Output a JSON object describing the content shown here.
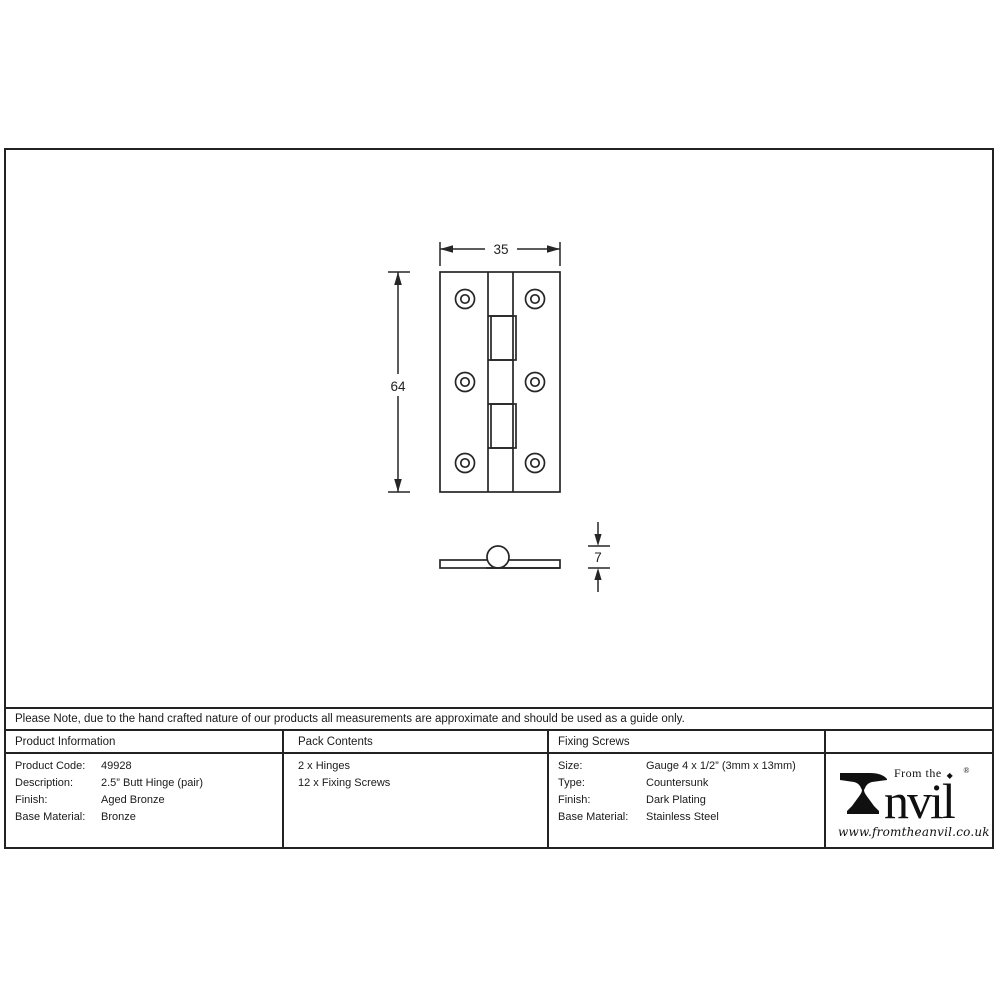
{
  "drawing": {
    "width_dim": "35",
    "height_dim": "64",
    "thickness_dim": "7"
  },
  "note": "Please Note, due to the hand crafted nature of our products all measurements are approximate and should be used as a guide only.",
  "table": {
    "product_info": {
      "header": "Product Information",
      "rows": [
        {
          "label": "Product Code:",
          "value": "49928"
        },
        {
          "label": "Description:",
          "value": "2.5” Butt Hinge (pair)"
        },
        {
          "label": "Finish:",
          "value": "Aged Bronze"
        },
        {
          "label": "Base Material:",
          "value": "Bronze"
        }
      ]
    },
    "pack_contents": {
      "header": "Pack Contents",
      "lines": [
        "2 x Hinges",
        "12 x Fixing Screws"
      ]
    },
    "fixing_screws": {
      "header": "Fixing Screws",
      "rows": [
        {
          "label": "Size:",
          "value": "Gauge 4 x 1/2” (3mm x 13mm)"
        },
        {
          "label": "Type:",
          "value": "Countersunk"
        },
        {
          "label": "Finish:",
          "value": "Dark Plating"
        },
        {
          "label": "Base Material:",
          "value": "Stainless Steel"
        }
      ]
    }
  },
  "logo": {
    "prefix": "From the",
    "diamond": "◆",
    "name": "nvil",
    "registered": "®",
    "url": "www.fromtheanvil.co.uk"
  },
  "colors": {
    "line": "#222222",
    "text": "#1a1a1a"
  }
}
